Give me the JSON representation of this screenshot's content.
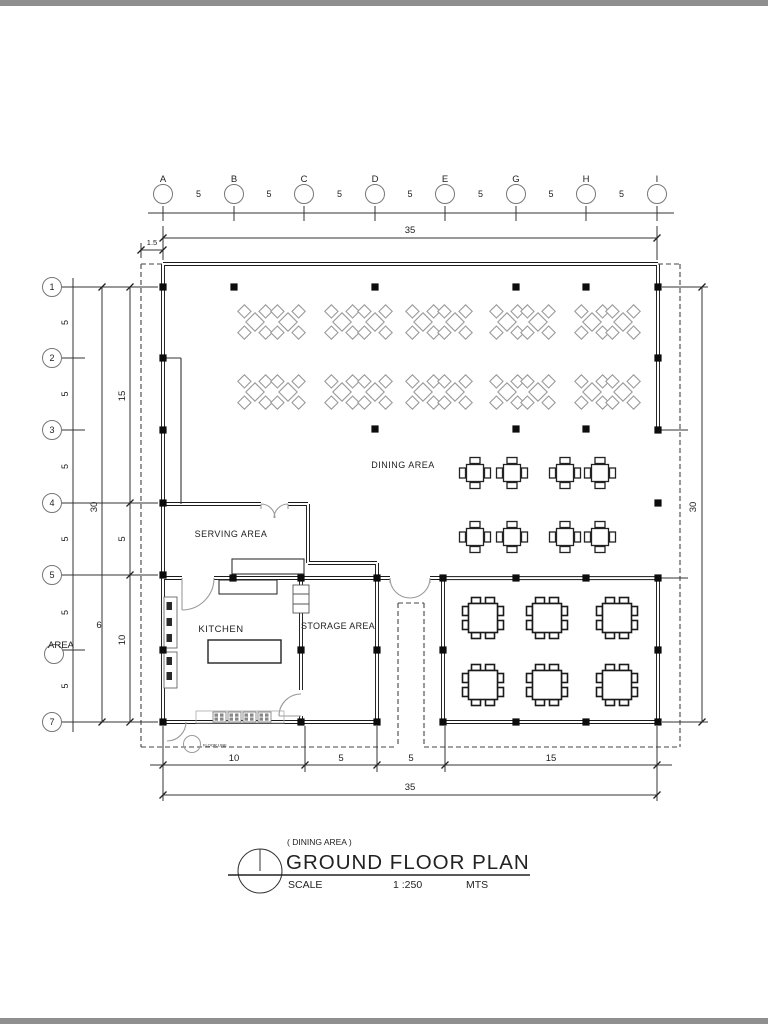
{
  "plan": {
    "rooms": {
      "dining": "DINING AREA",
      "serving": "SERVING AREA",
      "kitchen": "KITCHEN",
      "storage": "STORAGE AREA"
    },
    "grid_columns": {
      "labels": [
        "A",
        "B",
        "C",
        "D",
        "E",
        "G",
        "H",
        "I"
      ],
      "bay_label": "5"
    },
    "grid_rows": {
      "labels": [
        "1",
        "2",
        "3",
        "4",
        "5",
        "6",
        "7"
      ],
      "bay_label": "5",
      "stray_number": "6",
      "stray_word": "AREA"
    },
    "dims": {
      "top_total": "35",
      "eave_offset": "1.5",
      "left_outer_total": "30",
      "left_inner": [
        "15",
        "5",
        "10"
      ],
      "right_total": "30",
      "bottom_segments": [
        "10",
        "5",
        "5",
        "15"
      ],
      "bottom_total": "35"
    },
    "marker": {
      "floor_note": "FLOOR LINE"
    }
  },
  "title_block": {
    "area_note": "( DINING AREA )",
    "title": "GROUND FLOOR PLAN",
    "scale_label": "SCALE",
    "scale_value": "1 :250",
    "units_label": "MTS"
  }
}
